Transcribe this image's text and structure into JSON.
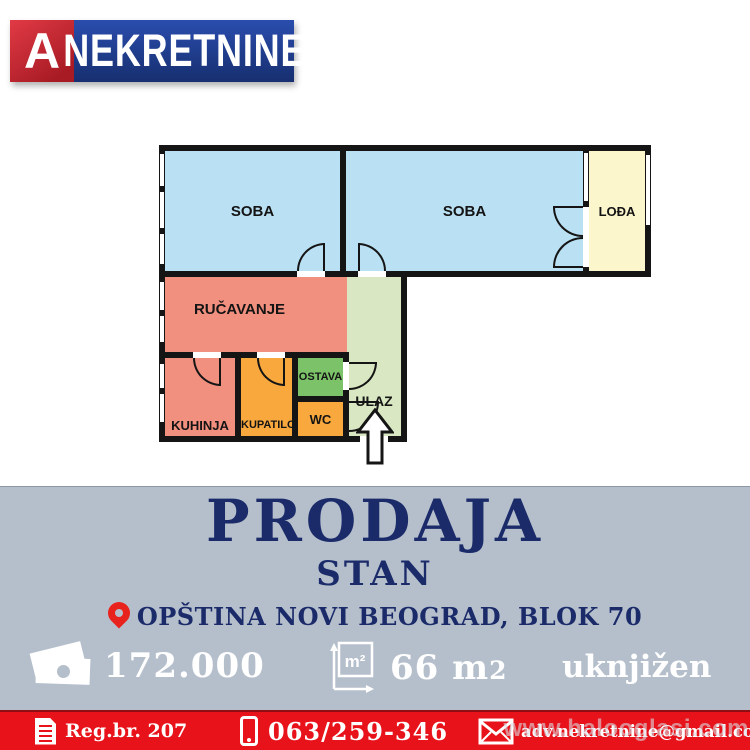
{
  "logo": {
    "letter": "A",
    "brand": "NEKRETNINE"
  },
  "floorplan": {
    "soba_left": {
      "label": "SOBA"
    },
    "soba_right": {
      "label": "SOBA"
    },
    "lodja": {
      "label": "LOĐA"
    },
    "rucavanje": {
      "label": "RUČAVANJE"
    },
    "kuhinja": {
      "label": "KUHINJA"
    },
    "kupatilo": {
      "label": "KUPATILO"
    },
    "ostava": {
      "label": "OSTAVA"
    },
    "wc": {
      "label": "WC"
    },
    "ulaz": {
      "label": "ULAZ"
    }
  },
  "listing": {
    "action": "PRODAJA",
    "type": "STAN",
    "location": "OPŠTINA NOVI BEOGRAD, BLOK 70",
    "price": "172.000",
    "area_value": "66 m",
    "area_exp": "2",
    "status": "uknjižen"
  },
  "icons": {
    "m2_label": "m²"
  },
  "footer": {
    "reg": "Reg.br. 207",
    "phone": "063/259-346",
    "email": "adv.nekretnine@gmail.com"
  },
  "watermark": {
    "text": "www.halooglasi.com"
  },
  "colors": {
    "navy": "#1b2b6a",
    "red": "#e8121b",
    "redDark": "#8e0e13",
    "graybg": "#b5bfcc",
    "wall": "#151515",
    "roomBlue": "#bae1f3",
    "roomYellow": "#fcf6cd",
    "roomSalmon": "#f2907f",
    "roomLightGreen": "#d9e8c3",
    "roomGreen": "#7cc268",
    "roomOrange": "#f9a83e",
    "logoBlue1": "#2a4dae",
    "logoBlue2": "#172f70",
    "logoRed1": "#e13a45",
    "logoRed2": "#a81b24",
    "pinRed": "#e8231d"
  }
}
